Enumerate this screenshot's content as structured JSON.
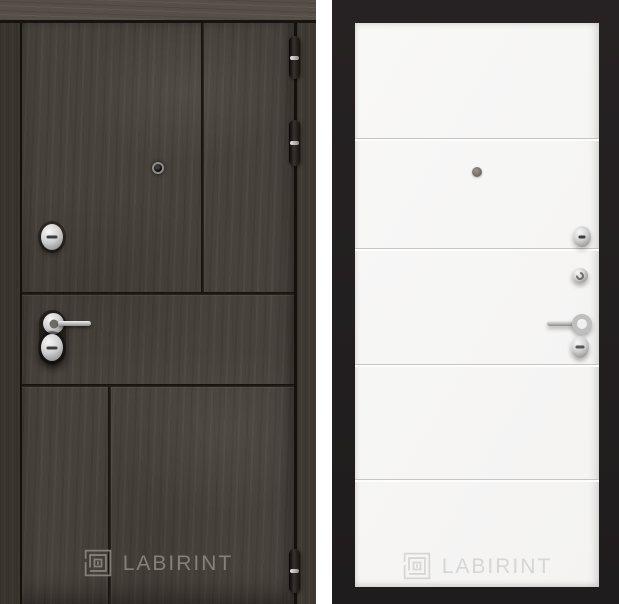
{
  "product": {
    "brand": "LABIRINT",
    "left_door": {
      "side": "exterior-dark-wood",
      "brand_label": "LABIRINT",
      "finish_color": "#48423c",
      "hardware": [
        "peephole",
        "lock-cylinder",
        "lever-handle",
        "keyhole-escutcheon",
        "hinge-top",
        "hinge-upper",
        "hinge-bottom"
      ]
    },
    "right_door": {
      "side": "interior-white",
      "brand_label": "LABIRINT",
      "finish_color": "#f6f5f4",
      "background_color": "#211e1f",
      "hardware": [
        "peephole",
        "latch-knob",
        "thumbturn",
        "lever-handle",
        "keyhole-escutcheon"
      ]
    },
    "logo_icon": "labirint-maze-icon"
  },
  "colors": {
    "wood_dark": "#48423c",
    "wood_jamb": "#39342e",
    "wood_lintel": "#564f47",
    "groove_dark": "#221d18",
    "panel_black": "#211e1f",
    "leaf_white": "#f6f5f4",
    "groove_light": "#c6c5c3",
    "logo_on_dark": "#928c83",
    "logo_on_light": "#d7d6d4",
    "metal": "#c9c9c9"
  }
}
